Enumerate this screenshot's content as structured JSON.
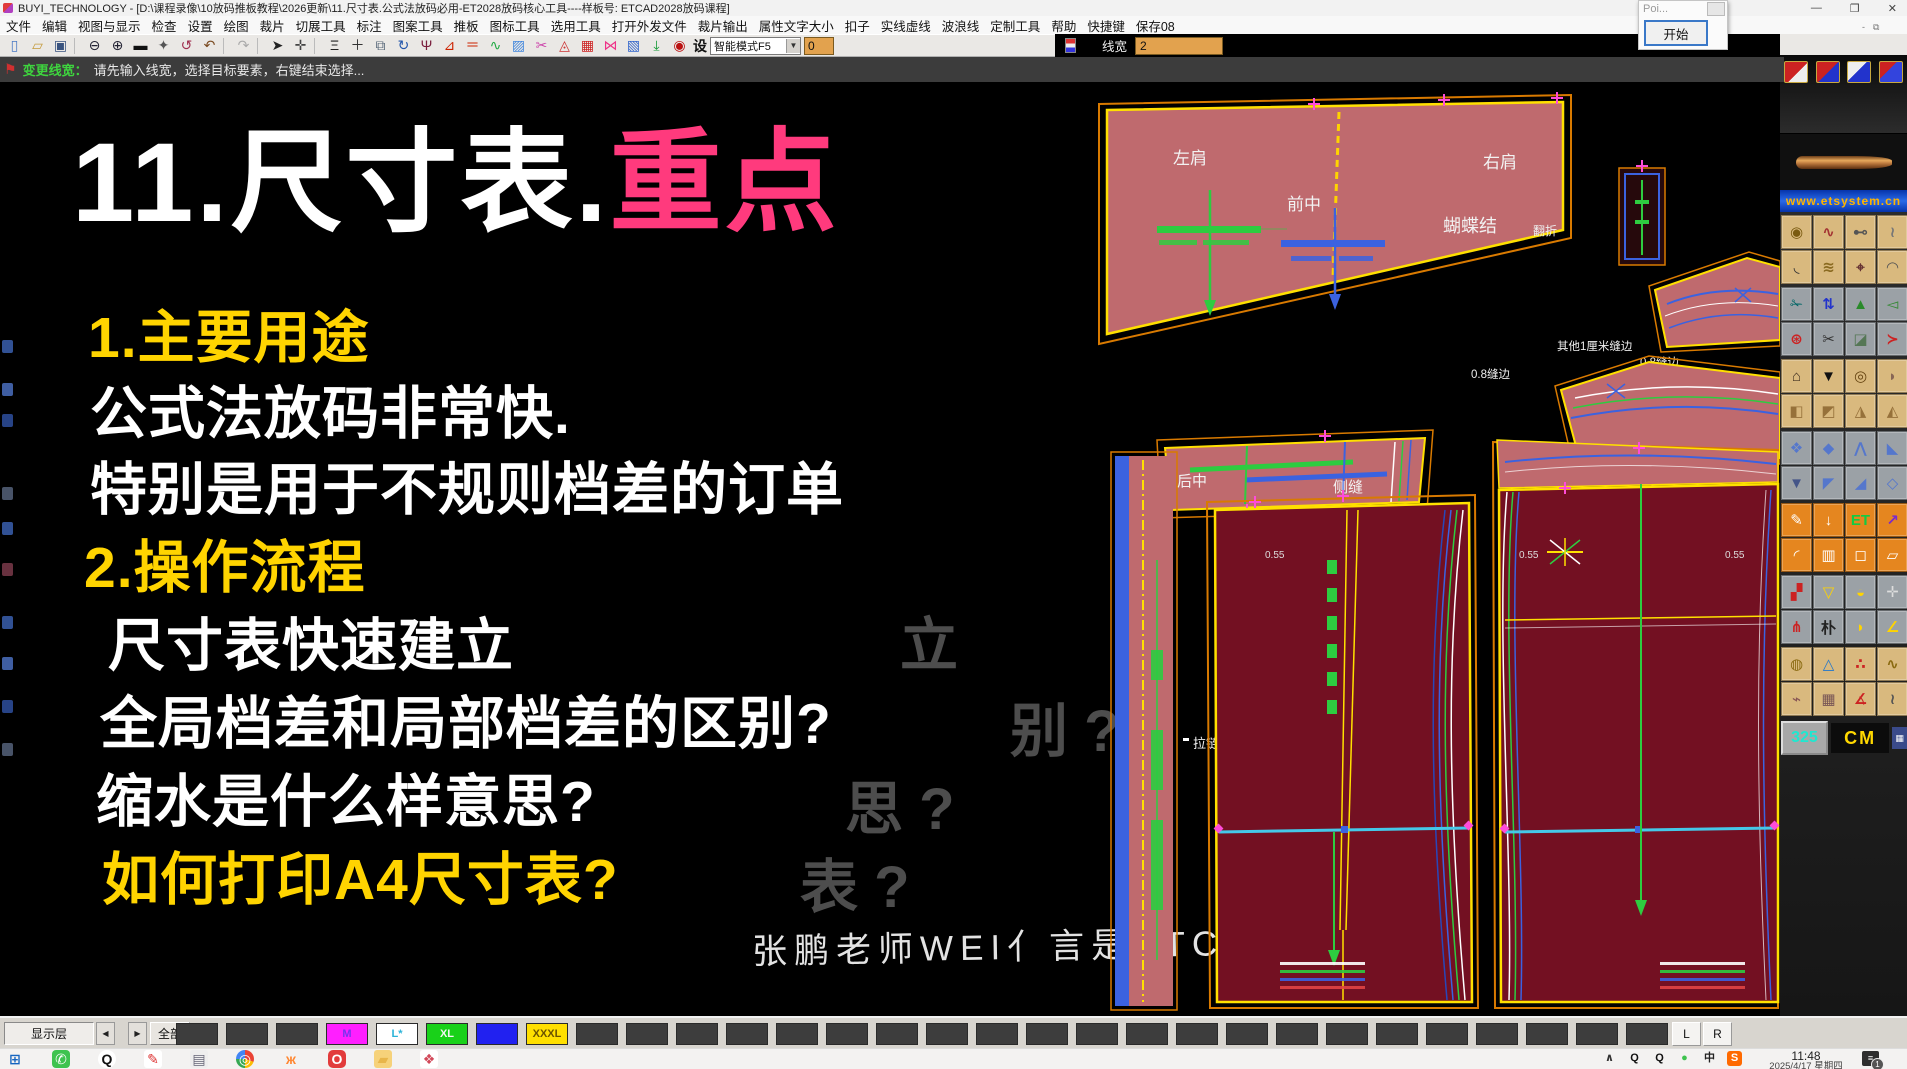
{
  "colors": {
    "accent_pink": "#ff3a7d",
    "accent_yellow": "#ffd400",
    "canvas_bg": "#000000",
    "piece_pink": "#bf6a6e",
    "piece_maroon": "#731022"
  },
  "window": {
    "title": "BUYI_TECHNOLOGY - [D:\\课程录像\\10放码推板教程\\2026更新\\11.尺寸表.公式法放码必用-ET2028放码核心工具----样板号: ETCAD2028放码课程]",
    "minimize": "—",
    "restore": "❐",
    "close": "✕",
    "mini_minimize": "-",
    "mini_restore": "⧉",
    "poi_title": "Poi...",
    "start_button": "开始"
  },
  "menu": {
    "items": [
      "文件",
      "编辑",
      "视图与显示",
      "检查",
      "设置",
      "绘图",
      "裁片",
      "切展工具",
      "标注",
      "图案工具",
      "推板",
      "图标工具",
      "选用工具",
      "打开外发文件",
      "裁片输出",
      "属性文字大小",
      "扣子",
      "实线虚线",
      "波浪线",
      "定制工具",
      "帮助",
      "快捷键",
      "保存08"
    ]
  },
  "toolbar": {
    "icons": [
      {
        "name": "new-file-icon",
        "g": "▯",
        "c": "#4a79c4"
      },
      {
        "name": "open-folder-icon",
        "g": "▱",
        "c": "#c49a3a"
      },
      {
        "name": "save-icon",
        "g": "▣",
        "c": "#39537f"
      },
      {
        "name": "sep",
        "g": "",
        "c": ""
      },
      {
        "name": "zoom-out-icon",
        "g": "⊖",
        "c": "#222233"
      },
      {
        "name": "zoom-in-icon",
        "g": "⊕",
        "c": "#222233"
      },
      {
        "name": "screen-icon",
        "g": "▬",
        "c": "#111111"
      },
      {
        "name": "pan-hand-icon",
        "g": "✦",
        "c": "#555555"
      },
      {
        "name": "rotate-view-icon",
        "g": "↺",
        "c": "#a03050"
      },
      {
        "name": "undo-icon",
        "g": "↶",
        "c": "#7a4a20"
      },
      {
        "name": "sep",
        "g": "",
        "c": ""
      },
      {
        "name": "redo-icon",
        "g": "↷",
        "c": "#aaaaaa"
      },
      {
        "name": "sep",
        "g": "",
        "c": ""
      },
      {
        "name": "select-cursor-icon",
        "g": "➤",
        "c": "#222222"
      },
      {
        "name": "move-tool-icon",
        "g": "✛",
        "c": "#444444"
      },
      {
        "name": "sep",
        "g": "",
        "c": ""
      },
      {
        "name": "smart-pen-icon",
        "g": "Ξ",
        "c": "#222222"
      },
      {
        "name": "add-point-icon",
        "g": "＋",
        "c": "#333333"
      },
      {
        "name": "mirror-icon",
        "g": "⧉",
        "c": "#556677"
      },
      {
        "name": "rotate-piece-icon",
        "g": "↻",
        "c": "#2255aa"
      },
      {
        "name": "psi-tool-icon",
        "g": "Ψ",
        "c": "#7a1f3d"
      },
      {
        "name": "angle-icon",
        "g": "⊿",
        "c": "#cc2200"
      },
      {
        "name": "parallel-icon",
        "g": "＝",
        "c": "#cc2200"
      },
      {
        "name": "smart-curve-icon",
        "g": "∿",
        "c": "#22aa44"
      },
      {
        "name": "hatch-icon",
        "g": "▨",
        "c": "#4488dd"
      },
      {
        "name": "curve-cut-icon",
        "g": "✂",
        "c": "#cc44aa"
      },
      {
        "name": "seam-icon",
        "g": "◬",
        "c": "#cc3333"
      },
      {
        "name": "color-grid-icon",
        "g": "▦",
        "c": "#cc2222"
      },
      {
        "name": "bowtie-icon",
        "g": "⋈",
        "c": "#ee3388"
      },
      {
        "name": "net-icon",
        "g": "▧",
        "c": "#3366cc"
      },
      {
        "name": "drop-arrow-icon",
        "g": "⤓",
        "c": "#119933"
      },
      {
        "name": "spiral-icon",
        "g": "◉",
        "c": "#bb1111"
      }
    ],
    "mode_label": "设",
    "mode_select": "智能模式F5",
    "dropdown_arrow": "▼",
    "field_value": "0",
    "linewidth_label": "线宽",
    "linewidth_value": "2"
  },
  "message_bar": {
    "flag": "⚑",
    "prefix": "变更线宽：",
    "text": "请先输入线宽，选择目标要素，右键结束选择..."
  },
  "overlay": {
    "title_white": "11.尺寸表.",
    "title_pink": "重点",
    "lines": [
      "1.主要用途",
      "公式法放码非常快.",
      "特别是用于不规则档差的订单",
      "2.操作流程",
      "尺寸表快速建立",
      "全局档差和局部档差的区别?",
      "缩水是什么样意思?",
      "如何打印A4尺寸表?"
    ],
    "ghosts": [
      "立",
      "别 ?",
      "思 ?",
      "表 ?"
    ],
    "signature": "张鹏老师WEI亻言是ETCAD2028"
  },
  "cad": {
    "labels": {
      "left_shoulder": "左肩",
      "front_center": "前中",
      "right_shoulder": "右肩",
      "bow": "蝴蝶结",
      "fold": "翻折",
      "seam_other": "其他1厘米缝边",
      "seam_08a": "0.8缝边",
      "seam_08b": "0.8缝边",
      "back_center": "后中",
      "side_seam": "侧缝",
      "lining_note": "里布的省道小0.5",
      "zipper": "拉链",
      "n1": "0.55",
      "n2": "0.55",
      "n3": "0.55"
    }
  },
  "left_strip": [
    {
      "bg": "#3a5fae",
      "mt": 258
    },
    {
      "bg": "#4a6fbe",
      "mt": 30
    },
    {
      "bg": "#2e4f9e",
      "mt": 18
    },
    {
      "bg": "#55627a",
      "mt": 60
    },
    {
      "bg": "#3a5fae",
      "mt": 22
    },
    {
      "bg": "#7a3a4a",
      "mt": 28
    },
    {
      "bg": "#3a5fae",
      "mt": 40
    },
    {
      "bg": "#4a6fbe",
      "mt": 28
    },
    {
      "bg": "#2e4f9e",
      "mt": 30
    },
    {
      "bg": "#55627a",
      "mt": 30
    }
  ],
  "palette": {
    "banner": "www.etsystem.cn",
    "scale_value": "325",
    "unit": "CM",
    "calc": "▦",
    "mini": [
      {
        "name": "palette-quick-1",
        "bg": "linear-gradient(135deg,#cc2222 55%,#eeeeee 55%)"
      },
      {
        "name": "palette-quick-2",
        "bg": "linear-gradient(135deg,#cc2222 50%,#2233cc 50%)"
      },
      {
        "name": "palette-quick-3",
        "bg": "linear-gradient(135deg,#eeeeee 45%,#2233cc 45%)"
      },
      {
        "name": "palette-quick-4",
        "bg": "linear-gradient(135deg,#cc2222 40%,#3344dd 40%)"
      }
    ],
    "g1": [
      {
        "g": "◉",
        "bg": "#d9b97e",
        "c": "#7a5a10"
      },
      {
        "g": "∿",
        "bg": "#d9b97e",
        "c": "#a33333"
      },
      {
        "g": "⊷",
        "bg": "#d9b97e",
        "c": "#555555"
      },
      {
        "g": "≀",
        "bg": "#d9b97e",
        "c": "#777777"
      },
      {
        "g": "◟",
        "bg": "#d9b97e",
        "c": "#333333"
      },
      {
        "g": "≋",
        "bg": "#d9b97e",
        "c": "#8a6a20"
      },
      {
        "g": "⌖",
        "bg": "#d9b97e",
        "c": "#663333"
      },
      {
        "g": "◠",
        "bg": "#d9b97e",
        "c": "#555555"
      }
    ],
    "g2": [
      {
        "g": "✁",
        "bg": "#9ba1a6",
        "c": "#006666"
      },
      {
        "g": "⇅",
        "bg": "#9ba1a6",
        "c": "#2233cc"
      },
      {
        "g": "▲",
        "bg": "#9ba1a6",
        "c": "#2a8a2a"
      },
      {
        "g": "◅",
        "bg": "#9ba1a6",
        "c": "#338833"
      },
      {
        "g": "⊛",
        "bg": "#9ba1a6",
        "c": "#cc2222"
      },
      {
        "g": "✂",
        "bg": "#9ba1a6",
        "c": "#333333"
      },
      {
        "g": "◪",
        "bg": "#9ba1a6",
        "c": "#557755"
      },
      {
        "g": "≻",
        "bg": "#9ba1a6",
        "c": "#cc2222"
      }
    ],
    "g3": [
      {
        "g": "⌂",
        "bg": "#d9b97e",
        "c": "#443322"
      },
      {
        "g": "▼",
        "bg": "#d9b97e",
        "c": "#111111"
      },
      {
        "g": "◎",
        "bg": "#d9b97e",
        "c": "#664411"
      },
      {
        "g": "◗",
        "bg": "#d9b97e",
        "c": "#886655"
      },
      {
        "g": "◧",
        "bg": "#d9b97e",
        "c": "#96713a"
      },
      {
        "g": "◩",
        "bg": "#d9b97e",
        "c": "#96713a"
      },
      {
        "g": "◮",
        "bg": "#d9b97e",
        "c": "#96713a"
      },
      {
        "g": "◭",
        "bg": "#d9b97e",
        "c": "#96713a"
      }
    ],
    "g4": [
      {
        "g": "❖",
        "bg": "#9ba1a6",
        "c": "#5577cc"
      },
      {
        "g": "◆",
        "bg": "#9ba1a6",
        "c": "#5577cc"
      },
      {
        "g": "⋀",
        "bg": "#9ba1a6",
        "c": "#5577cc"
      },
      {
        "g": "◣",
        "bg": "#9ba1a6",
        "c": "#5577cc"
      },
      {
        "g": "▼",
        "bg": "#9ba1a6",
        "c": "#445588"
      },
      {
        "g": "◤",
        "bg": "#9ba1a6",
        "c": "#5577cc"
      },
      {
        "g": "◢",
        "bg": "#9ba1a6",
        "c": "#5577cc"
      },
      {
        "g": "◇",
        "bg": "#9ba1a6",
        "c": "#5577cc"
      }
    ],
    "g5": [
      {
        "g": "✎",
        "bg": "#e5861f",
        "c": "#ffffff"
      },
      {
        "g": "↓",
        "bg": "#e5861f",
        "c": "#ffffff"
      },
      {
        "g": "ET",
        "bg": "#e5861f",
        "c": "#11cc44"
      },
      {
        "g": "↗",
        "bg": "#e5861f",
        "c": "#7a2acc"
      },
      {
        "g": "◜",
        "bg": "#e5861f",
        "c": "#ffffff"
      },
      {
        "g": "▥",
        "bg": "#e5861f",
        "c": "#ffffff"
      },
      {
        "g": "◻",
        "bg": "#e5861f",
        "c": "#ffffff"
      },
      {
        "g": "▱",
        "bg": "#e5861f",
        "c": "#ffffff"
      }
    ],
    "g6": [
      {
        "g": "▞",
        "bg": "#9ba1a6",
        "c": "#cc2222"
      },
      {
        "g": "▽",
        "bg": "#9ba1a6",
        "c": "#ffd400"
      },
      {
        "g": "◒",
        "bg": "#9ba1a6",
        "c": "#ffd400"
      },
      {
        "g": "✛",
        "bg": "#9ba1a6",
        "c": "#dddddd"
      },
      {
        "g": "⋔",
        "bg": "#9ba1a6",
        "c": "#cc2222"
      },
      {
        "g": "朴",
        "bg": "#9ba1a6",
        "c": "#222222"
      },
      {
        "g": "◗",
        "bg": "#9ba1a6",
        "c": "#ffd400"
      },
      {
        "g": "∠",
        "bg": "#9ba1a6",
        "c": "#ffd400"
      }
    ],
    "g7": [
      {
        "g": "◍",
        "bg": "#d9b97e",
        "c": "#8a6a10"
      },
      {
        "g": "△",
        "bg": "#d9b97e",
        "c": "#2277cc"
      },
      {
        "g": "∴",
        "bg": "#d9b97e",
        "c": "#cc2222"
      },
      {
        "g": "∿",
        "bg": "#d9b97e",
        "c": "#8a6a10"
      },
      {
        "g": "⌁",
        "bg": "#d9b97e",
        "c": "#885555"
      },
      {
        "g": "▦",
        "bg": "#d9b97e",
        "c": "#775555"
      },
      {
        "g": "∡",
        "bg": "#d9b97e",
        "c": "#cc2222"
      },
      {
        "g": "≀",
        "bg": "#d9b97e",
        "c": "#555555"
      }
    ]
  },
  "bottom_bar": {
    "layer_label": "显示层",
    "prev": "◀",
    "next": "▶",
    "all_label": "全部",
    "cells": [
      {
        "label": "",
        "bg": "#3d3d3d"
      },
      {
        "label": "",
        "bg": "#3d3d3d"
      },
      {
        "label": "",
        "bg": "#3d3d3d"
      },
      {
        "label": "M",
        "bg": "#ff1fff",
        "c": "#7733ee",
        "name": "size-m-button"
      },
      {
        "label": "L*",
        "bg": "#ffffff",
        "c": "#2bb3d8",
        "name": "size-l-button"
      },
      {
        "label": "XL",
        "bg": "#19d119",
        "c": "#f5f5f5",
        "name": "size-xl-button"
      },
      {
        "label": "",
        "bg": "#2121f0",
        "name": "size-xxl-button"
      },
      {
        "label": "XXXL",
        "bg": "#ffdf00",
        "c": "#6b5300",
        "name": "size-xxxl-button"
      },
      {
        "label": "",
        "bg": "#3d3d3d"
      },
      {
        "label": "",
        "bg": "#3d3d3d"
      },
      {
        "label": "",
        "bg": "#3d3d3d"
      },
      {
        "label": "",
        "bg": "#3d3d3d"
      },
      {
        "label": "",
        "bg": "#3d3d3d"
      },
      {
        "label": "",
        "bg": "#3d3d3d"
      },
      {
        "label": "",
        "bg": "#3d3d3d"
      },
      {
        "label": "",
        "bg": "#3d3d3d"
      },
      {
        "label": "",
        "bg": "#3d3d3d"
      },
      {
        "label": "",
        "bg": "#3d3d3d"
      },
      {
        "label": "",
        "bg": "#3d3d3d"
      },
      {
        "label": "",
        "bg": "#3d3d3d"
      },
      {
        "label": "",
        "bg": "#3d3d3d"
      },
      {
        "label": "",
        "bg": "#3d3d3d"
      },
      {
        "label": "",
        "bg": "#3d3d3d"
      },
      {
        "label": "",
        "bg": "#3d3d3d"
      },
      {
        "label": "",
        "bg": "#3d3d3d"
      },
      {
        "label": "",
        "bg": "#3d3d3d"
      },
      {
        "label": "",
        "bg": "#3d3d3d"
      },
      {
        "label": "",
        "bg": "#3d3d3d"
      },
      {
        "label": "",
        "bg": "#3d3d3d"
      },
      {
        "label": "",
        "bg": "#3d3d3d"
      }
    ],
    "lr": [
      "L",
      "R"
    ]
  },
  "taskbar": {
    "apps": [
      {
        "name": "start-button",
        "g": "⊞",
        "c": "#1565c0"
      },
      {
        "name": "wechat-icon",
        "g": "✆",
        "c": "#ffffff",
        "bg": "#3ec34f",
        "r": "4px"
      },
      {
        "name": "qq-icon",
        "g": "Q",
        "c": "#111111",
        "bg": "#ffffff",
        "r": "50%"
      },
      {
        "name": "paint-icon",
        "g": "✎",
        "c": "#dd3333",
        "bg": "#ffffff",
        "r": "3px"
      },
      {
        "name": "notes-icon",
        "g": "▤",
        "c": "#666677",
        "bg": "#eeeeee",
        "r": "3px"
      },
      {
        "name": "chrome-icon",
        "g": "◎",
        "c": "#ffffff",
        "bg": "conic-gradient(#ea4335 0 30%,#fbbc05 30% 50%,#34a853 50% 75%,#4285f4 75%)",
        "r": "50%"
      },
      {
        "name": "butterfly-icon",
        "g": "ж",
        "c": "#ff8833"
      },
      {
        "name": "red-o-icon",
        "g": "O",
        "c": "#ffffff",
        "bg": "#e23b3b",
        "r": "5px"
      },
      {
        "name": "folder-icon",
        "g": "▰",
        "c": "#e8b64a",
        "bg": "#f6d27a",
        "r": "3px"
      },
      {
        "name": "photos-icon",
        "g": "❖",
        "c": "#d2495a",
        "bg": "#ffffff",
        "r": "3px"
      }
    ],
    "tray": [
      {
        "name": "tray-expand-icon",
        "g": "∧",
        "c": "#333333"
      },
      {
        "name": "tray-qq-icon",
        "g": "Q",
        "c": "#111111"
      },
      {
        "name": "tray-qq2-icon",
        "g": "Q",
        "c": "#111111"
      },
      {
        "name": "tray-wechat-icon",
        "g": "●",
        "c": "#3ec34f"
      },
      {
        "name": "ime-icon",
        "g": "中",
        "c": "#222222"
      },
      {
        "name": "sogou-icon",
        "g": "S",
        "c": "#ffffff",
        "bg": "#ff6a00",
        "r": "3px"
      }
    ],
    "time": "11:48",
    "date": "2025/4/17 星期四",
    "notif_glyph": "≡",
    "badge": "1"
  }
}
